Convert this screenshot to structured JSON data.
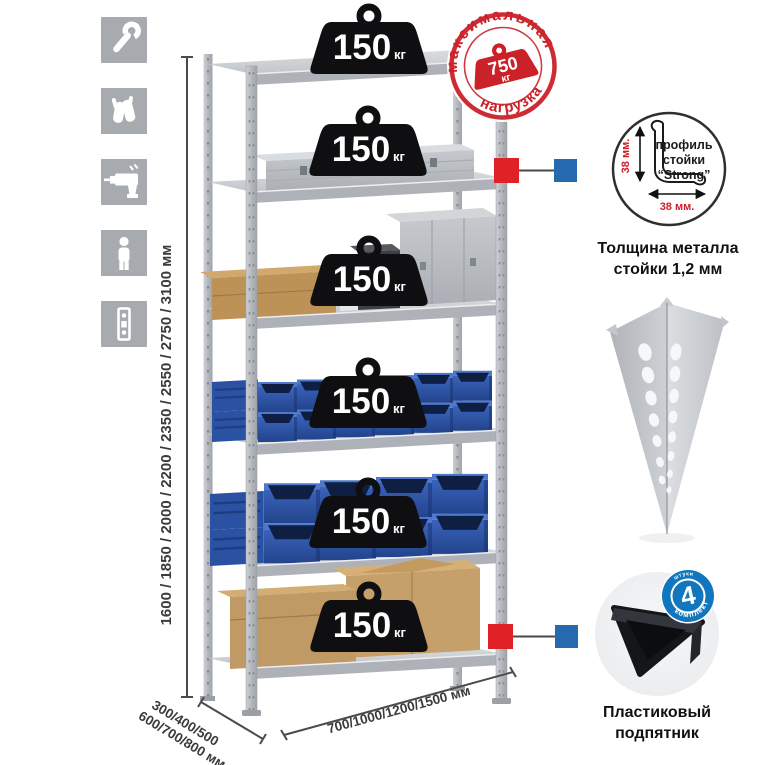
{
  "weights": {
    "value": "150",
    "unit": "кг"
  },
  "stamp": {
    "arc_top": "максимальная",
    "arc_bottom": "нагрузка",
    "value": "750",
    "unit": "кг"
  },
  "dimensions": {
    "height": "1600 / 1850 / 2000 / 2200 / 2350 / 2550 / 2750 / 3100 мм",
    "width": "700/1000/1200/1500 мм",
    "depth_line1": "300/400/500",
    "depth_line2": "600/700/800 мм"
  },
  "profile_detail": {
    "label_line1": "профиль",
    "label_line2": "стойки",
    "label_line3": "“Strong”",
    "dim_vertical": "38 мм.",
    "dim_horizontal": "38 мм.",
    "caption_line1": "Толщина металла",
    "caption_line2": "стойки 1,2 мм"
  },
  "foot_detail": {
    "badge_value": "4",
    "badge_arc_top": "штуки",
    "badge_arc_bottom": "в комплекте",
    "caption_line1": "Пластиковый",
    "caption_line2": "подпятник"
  },
  "icons": {
    "items": [
      {
        "name": "wrench"
      },
      {
        "name": "gloves"
      },
      {
        "name": "drill"
      },
      {
        "name": "person"
      },
      {
        "name": "level"
      }
    ]
  },
  "colors": {
    "stamp_red": "#cb2129",
    "callout_red": "#e02227",
    "callout_blue": "#2569ae",
    "badge_blue": "#1176bd",
    "bin_blue": "#2d54a8",
    "metal_gray": "#c3c7cb"
  }
}
